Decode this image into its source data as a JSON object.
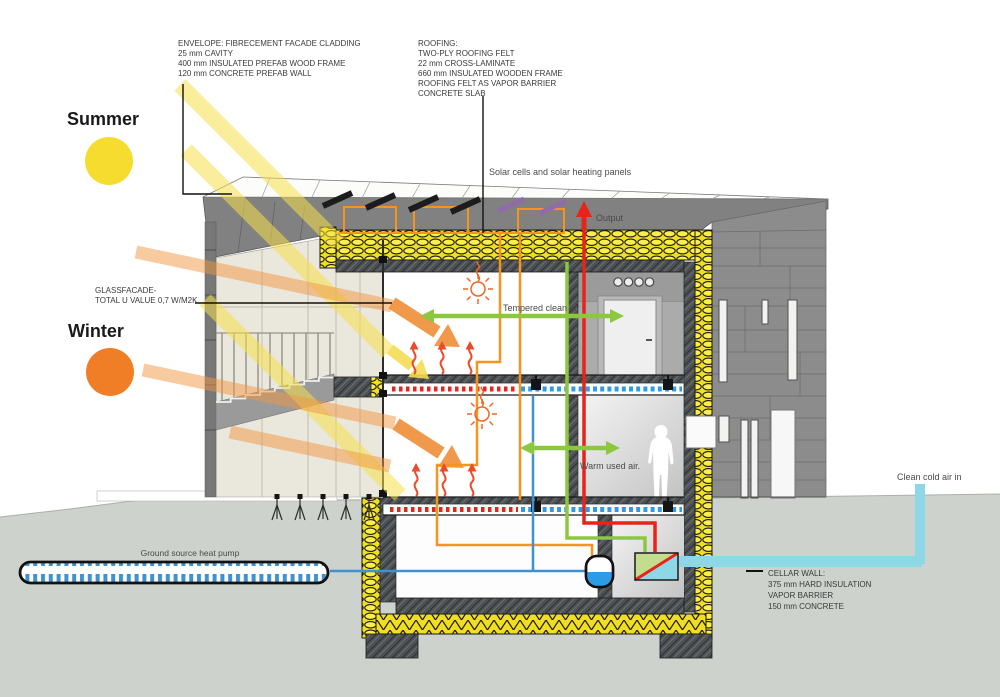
{
  "diagram_title": "Passive house energy concept section",
  "labels": {
    "summer": "Summer",
    "winter": "Winter",
    "solar_panels": "Solar cells and solar heating panels",
    "output": "Output",
    "tempered_air": "Tempered clean air",
    "warm_air": "Warm used air.",
    "cold_air": "Clean cold air in",
    "ground_pump": "Ground source heat pump",
    "envelope": {
      "lines": [
        "ENVELOPE: FIBRECEMENT FACADE CLADDING",
        "25 mm CAVITY",
        "400 mm INSULATED PREFAB WOOD FRAME",
        "120 mm CONCRETE PREFAB WALL"
      ]
    },
    "roofing": {
      "lines": [
        "ROOFING:",
        "TWO-PLY ROOFING FELT",
        "22 mm CROSS-LAMINATE",
        "660 mm INSULATED WOODEN FRAME",
        "ROOFING FELT AS VAPOR BARRIER",
        "CONCRETE SLAB"
      ]
    },
    "glassfacade": {
      "lines": [
        "GLASSFACADE-",
        "TOTAL U VALUE 0,7 W/M2K"
      ]
    },
    "cellar": {
      "lines": [
        "CELLAR WALL:",
        "375 mm HARD INSULATION",
        "VAPOR BARRIER",
        "150 mm CONCRETE"
      ]
    }
  },
  "colors": {
    "summer_sun": "#F5DC2E",
    "winter_sun": "#F07E26",
    "insulation_yellow": "#F6E52C",
    "solar_circuit_orange": "#F7941D",
    "hot_pipe_red": "#E8231A",
    "clean_air_green": "#8DC63F",
    "water_blue": "#3F92D2",
    "cold_air_cyan": "#8ED7E6",
    "facade_gray": "#8C8C8C",
    "ground_gray": "#CDD2CC"
  }
}
